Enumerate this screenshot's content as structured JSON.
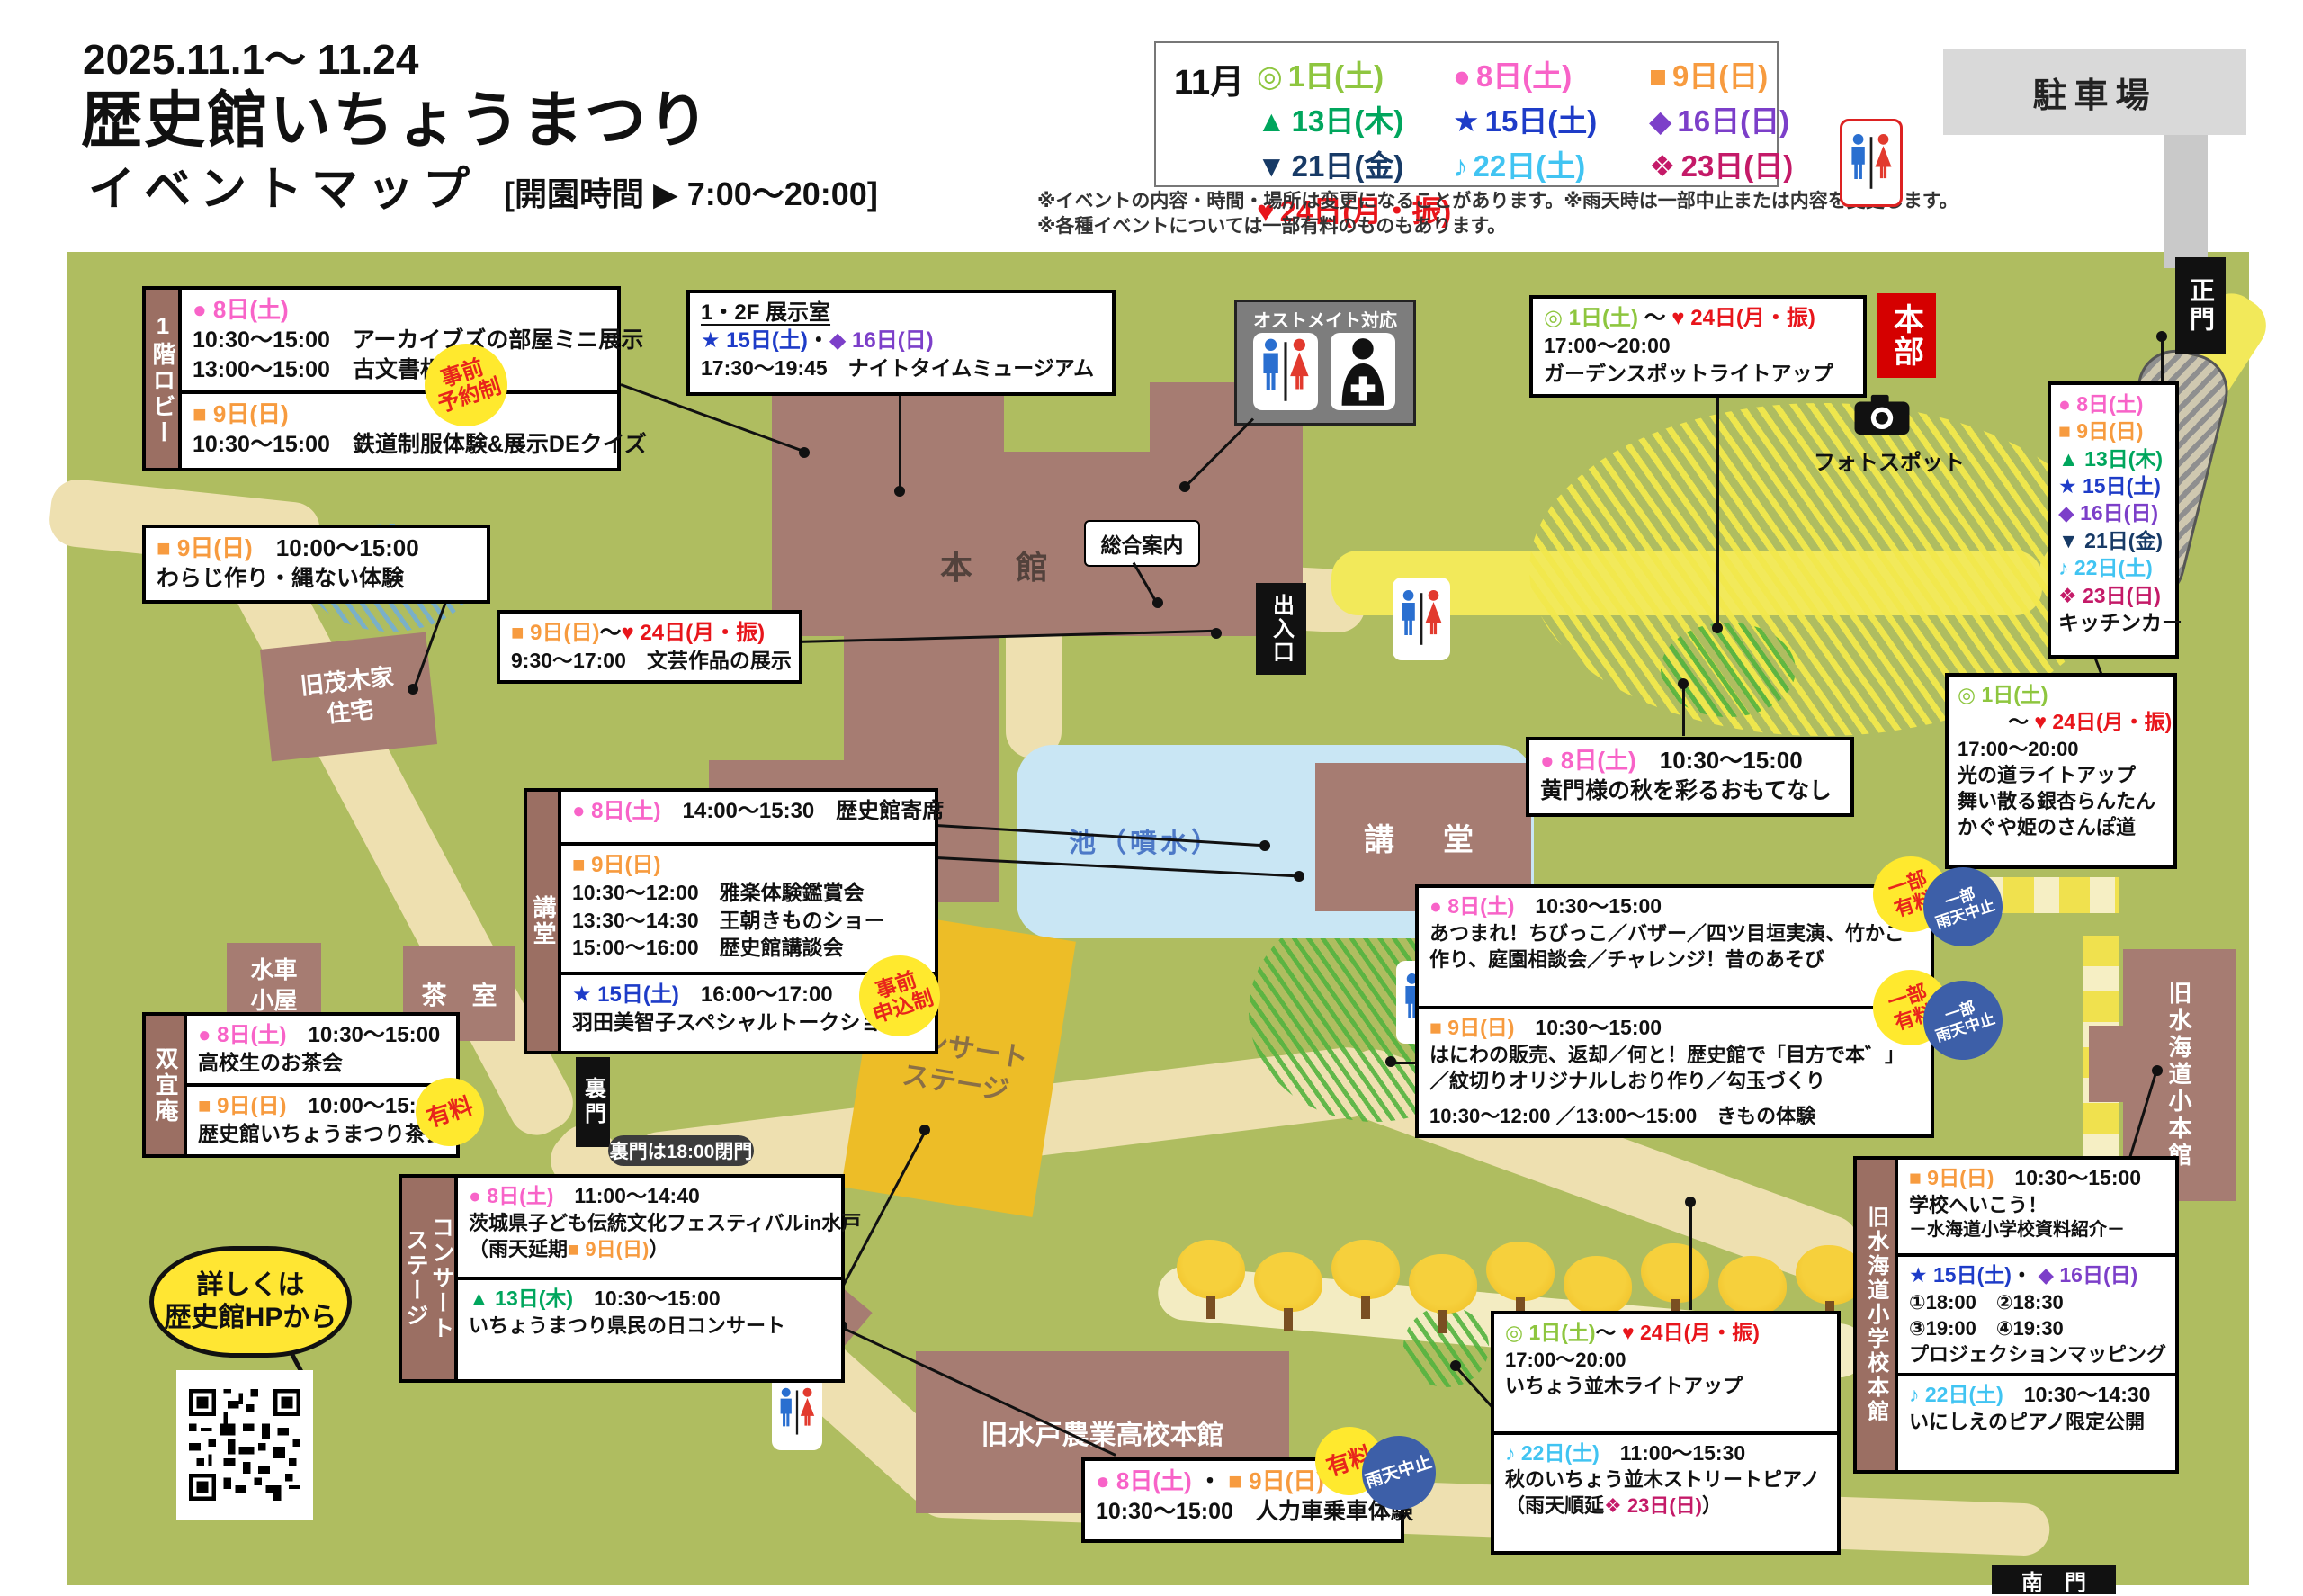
{
  "header": {
    "dates": "2025.11.1～ 11.24",
    "title": "歴史館いちょうまつり",
    "subtitle": "イベントマップ",
    "hours": "[開園時間 ▶ 7:00～20:00]",
    "note1": "※イベントの内容・時間・場所は変更になることがあります。※雨天時は一部中止または内容を変更します。",
    "note2": "※各種イベントについては一部有料のものもあります。"
  },
  "legend": {
    "month": "11月",
    "items": [
      {
        "marker": "◎",
        "label": "1日(土)",
        "color": "#8ec63f"
      },
      {
        "marker": "●",
        "label": "8日(土)",
        "color": "#f863c8"
      },
      {
        "marker": "■",
        "label": "9日(日)",
        "color": "#f79b3f"
      },
      {
        "marker": "▲",
        "label": "13日(木)",
        "color": "#00a65d"
      },
      {
        "marker": "★",
        "label": "15日(土)",
        "color": "#1e3cc8"
      },
      {
        "marker": "◆",
        "label": "16日(日)",
        "color": "#7c3fc9"
      },
      {
        "marker": "▼",
        "label": "21日(金)",
        "color": "#173a66"
      },
      {
        "marker": "♪",
        "label": "22日(土)",
        "color": "#41c4f2"
      },
      {
        "marker": "❖",
        "label": "23日(日)",
        "color": "#c41a68"
      },
      {
        "marker": "♥",
        "label": "24日(月・振)",
        "color": "#e8151b"
      }
    ]
  },
  "badges": {
    "reserve": "事前\n予約制",
    "apply": "事前\n申込制",
    "fee": "有料",
    "partial_fee": "一部\n有料",
    "rain": "雨天中止",
    "partial_rain": "一部\n雨天中止"
  },
  "map": {
    "parking": "駐車場",
    "main_gate": "正門",
    "south_gate": "南　門",
    "back_gate": "裏門",
    "back_gate_note": "裏門は18:00閉門",
    "hq": "本部",
    "photo_spot": "フォトスポット",
    "info_desk": "総合案内",
    "entrance": "出入口",
    "main_hall": "本　館",
    "memorial_room": "一橋徳川家\n記念室",
    "auditorium": "講　堂",
    "pond": "池（噴水）",
    "stage": "コンサート\nステージ",
    "moteki_house": "旧茂木家\n住宅",
    "waterwheel_hut": "水車\n小屋",
    "tea_house": "茶　室",
    "agri_school": "旧水戸農業高校本館",
    "mitsukaido_school": "旧水海道小本館",
    "ostomate": "オストメイト対応",
    "hp_bubble": "詳しくは\n歴史館HPから"
  },
  "events": {
    "lobby": {
      "label": "1階ロビー",
      "s1_date": "● 8日(土)",
      "s1_l1": "10:30～15:00　アーカイブズの部屋ミニ展示",
      "s1_l2": "13:00～15:00　古文書相談会",
      "s2_date": "■ 9日(日)",
      "s2_l1": "10:30～15:00　鉄道制服体験&展示DEクイズ"
    },
    "waraji": {
      "date": "■ 9日(日)",
      "time": "10:00～15:00",
      "body": "わらじ作り・縄ない体験"
    },
    "exhibit": {
      "title": "1・2F 展示室",
      "date1": "★ 15日(土)",
      "sep": "・",
      "date2": "◆ 16日(日)",
      "body": "17:30～19:45　ナイトタイムミュージアム"
    },
    "garden": {
      "date1": "◎ 1日(土)",
      "sep": "～",
      "date2": "♥ 24日(月・振)",
      "l1": "17:00～20:00",
      "l2": "ガーデンスポットライトアップ"
    },
    "bungei": {
      "date1": "■ 9日(日)",
      "sep": "～",
      "date2": "♥ 24日(月・振)",
      "l1": "9:30～17:00　文芸作品の展示"
    },
    "komon": {
      "date": "● 8日(土)",
      "time": "10:30～15:00",
      "l1": "黄門様の秋を彩るおもてなし"
    },
    "kodo": {
      "label": "講堂",
      "s1_date": "● 8日(土)",
      "s1_rest": "14:00～15:30　歴史館寄席",
      "s2_date": "■ 9日(日)",
      "s2_l1": "10:30～12:00　雅楽体験鑑賞会",
      "s2_l2": "13:30～14:30　王朝きものショー",
      "s2_l3": "15:00～16:00　歴史館講談会",
      "s3_date": "★ 15日(土)",
      "s3_time": "16:00～17:00",
      "s3_l1": "羽田美智子スペシャルトークショー"
    },
    "sogian": {
      "label": "双宜庵",
      "s1_date": "● 8日(土)",
      "s1_time": "10:30～15:00",
      "s1_l1": "高校生のお茶会",
      "s2_date": "■ 9日(日)",
      "s2_time": "10:00～15:00",
      "s2_l1": "歴史館いちょうまつり茶会"
    },
    "plaza": {
      "s1_date": "● 8日(土)",
      "s1_time": "10:30～15:00",
      "s1_l1": "あつまれ！ちびっこ／バザー／四ツ目垣実演、竹かご",
      "s1_l2": "作り、庭園相談会／チャレンジ！昔のあそび",
      "s2_date": "■ 9日(日)",
      "s2_time": "10:30～15:00",
      "s2_l1": "はにわの販売、返却／何と！歴史館で「目方で本゛」",
      "s2_l2": "／紋切りオリジナルしおり作り／勾玉づくり",
      "s2_l3": "10:30～12:00 ／13:00～15:00　きもの体験"
    },
    "concert": {
      "label": "コンサート\nステージ",
      "s1_date": "● 8日(土)",
      "s1_time": "11:00～14:40",
      "s1_l1": "茨城県子ども伝統文化フェスティバルin水戸",
      "s1_l2a": "（雨天延期",
      "s1_l2b": "■ 9日(日)",
      "s1_l2c": "）",
      "s2_date": "▲ 13日(木)",
      "s2_time": "10:30～15:00",
      "s2_l1": "いちょうまつり県民の日コンサート"
    },
    "kitchen": {
      "d8": "● 8日(土)",
      "d9": "■ 9日(日)",
      "d13": "▲ 13日(木)",
      "d15": "★ 15日(土)",
      "d16": "◆ 16日(日)",
      "d21": "▼ 21日(金)",
      "d22": "♪ 22日(土)",
      "d23": "❖ 23日(日)",
      "title": "キッチンカー"
    },
    "hikari": {
      "date1": "◎ 1日(土)",
      "sep": "～",
      "date2": "♥ 24日(月・振)",
      "l1": "17:00～20:00",
      "l2": "光の道ライトアップ",
      "l3": "舞い散る銀杏らんたん",
      "l4": "かぐや姫のさんぽ道"
    },
    "namiki": {
      "date1": "◎ 1日(土)",
      "sep": "～",
      "date2": "♥ 24日(月・振)",
      "l1": "17:00～20:00",
      "l2": "いちょう並木ライトアップ"
    },
    "piano": {
      "date": "♪ 22日(土)",
      "time": "11:00～15:30",
      "l1": "秋のいちょう並木ストリートピアノ",
      "l2a": "（雨天順延",
      "l2b": "❖ 23日(日)",
      "l2c": "）"
    },
    "rickshaw": {
      "date1": "● 8日(土)",
      "sep": "・",
      "date2": "■ 9日(日)",
      "l1": "10:30～15:00　人力車乗車体験"
    },
    "school": {
      "label": "旧水海道小学校本館",
      "s1_date": "■ 9日(日)",
      "s1_time": "10:30～15:00",
      "s1_l1": "学校へいこう！",
      "s1_l2": "－水海道小学校資料紹介－",
      "s2_date1": "★ 15日(土)",
      "s2_sep": "・",
      "s2_date2": "◆ 16日(日)",
      "s2_l1": "①18:00　②18:30",
      "s2_l2": "③19:00　④19:30",
      "s2_l3": "プロジェクションマッピング",
      "s3_date": "♪ 22日(土)",
      "s3_time": "10:30～14:30",
      "s3_l1": "いにしえのピアノ限定公開"
    }
  },
  "colors": {
    "map_bg": "#afbd60",
    "building": "#a67c72",
    "road": "#eee0b0",
    "road_yellow": "#f2e95a",
    "pond": "#c9e6f4",
    "stage": "#edbd27",
    "hq_red": "#d50000",
    "badge_yellow": "#ffe92e",
    "badge_blue": "#3d5fa8"
  }
}
